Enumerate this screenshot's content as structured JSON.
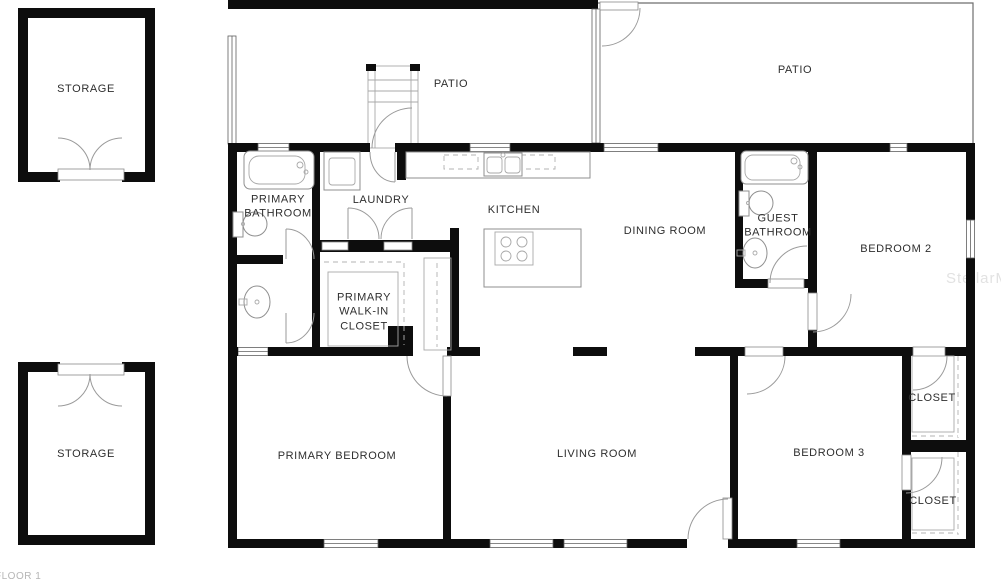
{
  "plan": {
    "floor_label": "FLOOR 1",
    "watermark": "StellarMLS",
    "colors": {
      "wall": "#0d0d0d",
      "background": "#ffffff",
      "label_text": "#2e2e2e",
      "floor_label_text": "#b5b5b5",
      "watermark_text": "#e2e2e2",
      "fixture_stroke": "#8f8f8f"
    },
    "rooms": [
      {
        "id": "storage-top",
        "label": "STORAGE"
      },
      {
        "id": "patio-left",
        "label": "PATIO"
      },
      {
        "id": "patio-right",
        "label": "PATIO"
      },
      {
        "id": "primary-bathroom",
        "label": "PRIMARY BATHROOM"
      },
      {
        "id": "laundry",
        "label": "LAUNDRY"
      },
      {
        "id": "kitchen",
        "label": "KITCHEN"
      },
      {
        "id": "dining-room",
        "label": "DINING ROOM"
      },
      {
        "id": "guest-bathroom",
        "label": "GUEST BATHROOM"
      },
      {
        "id": "bedroom-2",
        "label": "BEDROOM 2"
      },
      {
        "id": "primary-walk-in-closet",
        "label": "PRIMARY WALK-IN CLOSET"
      },
      {
        "id": "storage-bottom",
        "label": "STORAGE"
      },
      {
        "id": "primary-bedroom",
        "label": "PRIMARY BEDROOM"
      },
      {
        "id": "living-room",
        "label": "LIVING ROOM"
      },
      {
        "id": "bedroom-3",
        "label": "BEDROOM 3"
      },
      {
        "id": "closet-bedroom-2",
        "label": "CLOSET"
      },
      {
        "id": "closet-bedroom-3",
        "label": "CLOSET"
      }
    ]
  }
}
